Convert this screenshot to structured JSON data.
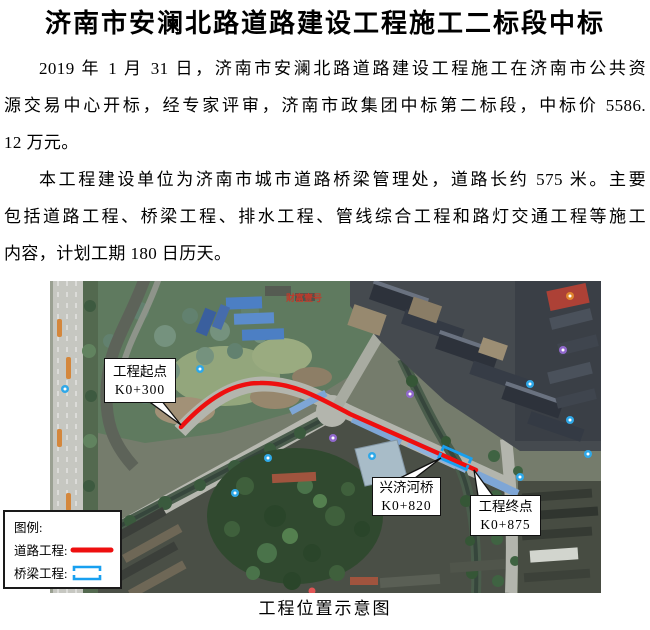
{
  "document": {
    "title": "济南市安澜北路道路建设工程施工二标段中标",
    "paragraph1_lines": [
      "2019 年 1 月 31 日，济南市安澜北路道路建设工程施工在济南市公共资",
      "源交易中心开标，经专家评审，济南市政集团中标第二标段，中标价 5586.",
      "12 万元。"
    ],
    "paragraph2_lines": [
      "本工程建设单位为济南市城市道路桥梁管理处，道路长约 575 米。主要",
      "包括道路工程、桥梁工程、排水工程、管线综合工程和路灯交通工程等施工",
      "内容，计划工期 180 日历天。"
    ],
    "figure_caption": "工程位置示意图"
  },
  "map": {
    "poi_label": "财富壹号",
    "callouts": {
      "start": {
        "line1": "工程起点",
        "line2": "K0+300"
      },
      "bridge": {
        "line1": "兴济河桥",
        "line2": "K0+820"
      },
      "end": {
        "line1": "工程终点",
        "line2": "K0+875"
      }
    },
    "legend": {
      "heading": "图例:",
      "road_label": "道路工程:",
      "bridge_label": "桥梁工程:"
    },
    "colors": {
      "route_red": "#ee0f0f",
      "bridge_blue": "#18a0f0"
    }
  }
}
